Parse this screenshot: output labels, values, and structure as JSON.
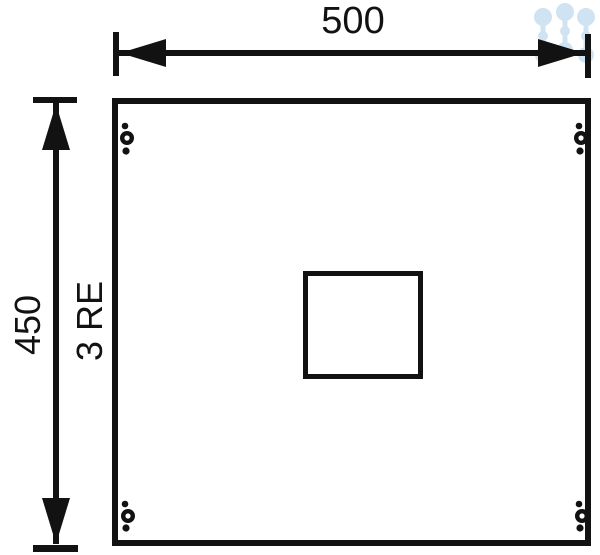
{
  "diagram": {
    "labels": {
      "width": "500",
      "height": "450",
      "rack_units": "3 RE"
    },
    "colors": {
      "ink": "#121212",
      "background": "#ffffff",
      "watermark": "#cfe3f2"
    },
    "icons": {
      "watermark": "dots-cluster-watermark-icon"
    }
  }
}
